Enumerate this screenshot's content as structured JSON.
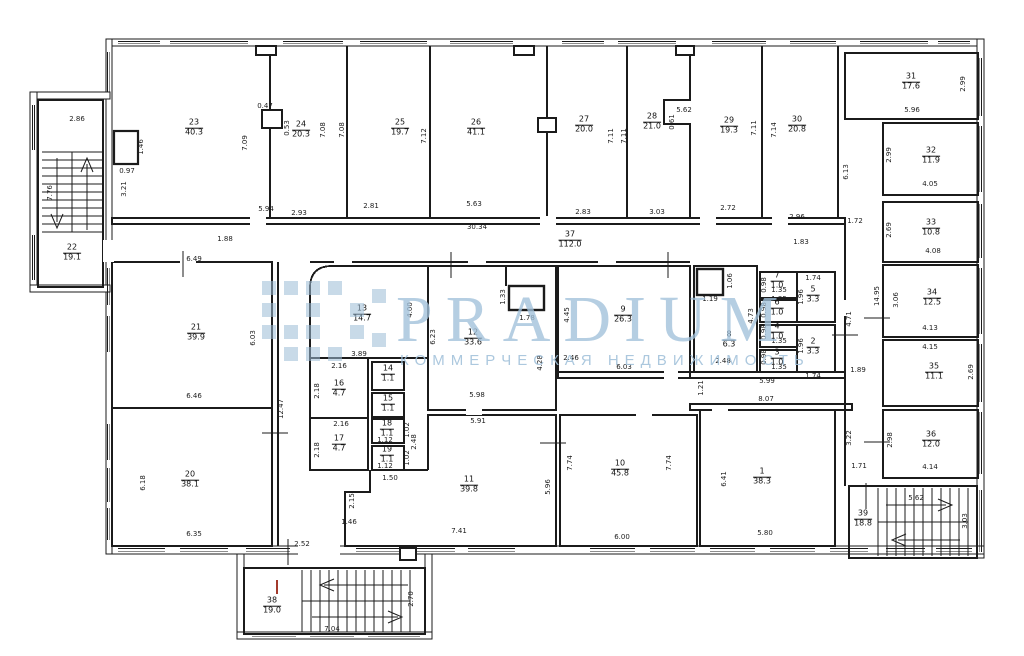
{
  "watermark": {
    "brand": "PRADIUM",
    "subtitle": "КОММЕРЧЕСКАЯ НЕДВИЖИМОСТЬ",
    "color": "#a0c0da"
  },
  "plan": {
    "rooms": [
      {
        "n": "1",
        "a": "38.3",
        "x": 762,
        "y": 477
      },
      {
        "n": "2",
        "a": "3.3",
        "x": 813,
        "y": 347
      },
      {
        "n": "3",
        "a": "1.0",
        "x": 777,
        "y": 358
      },
      {
        "n": "4",
        "a": "1.0",
        "x": 777,
        "y": 332
      },
      {
        "n": "5",
        "a": "3.3",
        "x": 813,
        "y": 295
      },
      {
        "n": "6",
        "a": "1.0",
        "x": 777,
        "y": 308
      },
      {
        "n": "7",
        "a": "1.0",
        "x": 777,
        "y": 281
      },
      {
        "n": "8",
        "a": "6.3",
        "x": 729,
        "y": 340
      },
      {
        "n": "9",
        "a": "26.3",
        "x": 623,
        "y": 315
      },
      {
        "n": "10",
        "a": "45.8",
        "x": 620,
        "y": 469
      },
      {
        "n": "11",
        "a": "39.8",
        "x": 469,
        "y": 485
      },
      {
        "n": "12",
        "a": "33.6",
        "x": 473,
        "y": 338
      },
      {
        "n": "13",
        "a": "14.7",
        "x": 362,
        "y": 314
      },
      {
        "n": "14",
        "a": "1.1",
        "x": 388,
        "y": 374
      },
      {
        "n": "15",
        "a": "1.1",
        "x": 388,
        "y": 404
      },
      {
        "n": "16",
        "a": "4.7",
        "x": 339,
        "y": 389
      },
      {
        "n": "17",
        "a": "4.7",
        "x": 339,
        "y": 444
      },
      {
        "n": "18",
        "a": "1.1",
        "x": 387,
        "y": 429
      },
      {
        "n": "19",
        "a": "1.1",
        "x": 387,
        "y": 455
      },
      {
        "n": "20",
        "a": "38.1",
        "x": 190,
        "y": 480
      },
      {
        "n": "21",
        "a": "39.9",
        "x": 196,
        "y": 333
      },
      {
        "n": "22",
        "a": "19.1",
        "x": 72,
        "y": 253
      },
      {
        "n": "23",
        "a": "40.3",
        "x": 194,
        "y": 128
      },
      {
        "n": "24",
        "a": "20.3",
        "x": 301,
        "y": 130
      },
      {
        "n": "25",
        "a": "19.7",
        "x": 400,
        "y": 128
      },
      {
        "n": "26",
        "a": "41.1",
        "x": 476,
        "y": 128
      },
      {
        "n": "27",
        "a": "20.0",
        "x": 584,
        "y": 125
      },
      {
        "n": "28",
        "a": "21.0",
        "x": 652,
        "y": 122
      },
      {
        "n": "29",
        "a": "19.3",
        "x": 729,
        "y": 126
      },
      {
        "n": "30",
        "a": "20.8",
        "x": 797,
        "y": 125
      },
      {
        "n": "31",
        "a": "17.6",
        "x": 911,
        "y": 82
      },
      {
        "n": "32",
        "a": "11.9",
        "x": 931,
        "y": 156
      },
      {
        "n": "33",
        "a": "10.8",
        "x": 931,
        "y": 228
      },
      {
        "n": "34",
        "a": "12.5",
        "x": 932,
        "y": 298
      },
      {
        "n": "35",
        "a": "11.1",
        "x": 934,
        "y": 372
      },
      {
        "n": "36",
        "a": "12.0",
        "x": 931,
        "y": 440
      },
      {
        "n": "37",
        "a": "112.0",
        "x": 570,
        "y": 240
      },
      {
        "n": "38",
        "a": "19.0",
        "x": 272,
        "y": 606
      },
      {
        "n": "39",
        "a": "18.8",
        "x": 863,
        "y": 519
      }
    ],
    "dims": [
      {
        "v": "2.86",
        "x": 77,
        "y": 119,
        "o": "h"
      },
      {
        "v": "7.76",
        "x": 50,
        "y": 193,
        "o": "v"
      },
      {
        "v": "1.46",
        "x": 141,
        "y": 147,
        "o": "v"
      },
      {
        "v": "0.97",
        "x": 127,
        "y": 171,
        "o": "h"
      },
      {
        "v": "3.21",
        "x": 124,
        "y": 189,
        "o": "v"
      },
      {
        "v": "5.94",
        "x": 266,
        "y": 209,
        "o": "h"
      },
      {
        "v": "7.09",
        "x": 245,
        "y": 143,
        "o": "v"
      },
      {
        "v": "0.47",
        "x": 265,
        "y": 106,
        "o": "h"
      },
      {
        "v": "0.53",
        "x": 287,
        "y": 128,
        "o": "v"
      },
      {
        "v": "2.93",
        "x": 299,
        "y": 213,
        "o": "h"
      },
      {
        "v": "7.08",
        "x": 323,
        "y": 130,
        "o": "v"
      },
      {
        "v": "7.08",
        "x": 342,
        "y": 130,
        "o": "v"
      },
      {
        "v": "2.81",
        "x": 371,
        "y": 206,
        "o": "h"
      },
      {
        "v": "7.12",
        "x": 424,
        "y": 136,
        "o": "v"
      },
      {
        "v": "5.63",
        "x": 474,
        "y": 204,
        "o": "h"
      },
      {
        "v": "30.34",
        "x": 477,
        "y": 227,
        "o": "h"
      },
      {
        "v": "2.83",
        "x": 583,
        "y": 212,
        "o": "h"
      },
      {
        "v": "7.11",
        "x": 611,
        "y": 136,
        "o": "v"
      },
      {
        "v": "7.11",
        "x": 624,
        "y": 136,
        "o": "v"
      },
      {
        "v": "3.03",
        "x": 657,
        "y": 212,
        "o": "h"
      },
      {
        "v": "5.62",
        "x": 684,
        "y": 110,
        "o": "h"
      },
      {
        "v": "0.61",
        "x": 672,
        "y": 122,
        "o": "v"
      },
      {
        "v": "2.72",
        "x": 728,
        "y": 208,
        "o": "h"
      },
      {
        "v": "7.11",
        "x": 754,
        "y": 128,
        "o": "v"
      },
      {
        "v": "7.14",
        "x": 774,
        "y": 130,
        "o": "v"
      },
      {
        "v": "2.96",
        "x": 797,
        "y": 217,
        "o": "h"
      },
      {
        "v": "1.88",
        "x": 225,
        "y": 239,
        "o": "h"
      },
      {
        "v": "1.83",
        "x": 801,
        "y": 242,
        "o": "h"
      },
      {
        "v": "1.72",
        "x": 855,
        "y": 221,
        "o": "h"
      },
      {
        "v": "6.13",
        "x": 846,
        "y": 172,
        "o": "v"
      },
      {
        "v": "5.96",
        "x": 912,
        "y": 110,
        "o": "h"
      },
      {
        "v": "2.99",
        "x": 963,
        "y": 84,
        "o": "v"
      },
      {
        "v": "4.05",
        "x": 930,
        "y": 184,
        "o": "h"
      },
      {
        "v": "2.99",
        "x": 889,
        "y": 155,
        "o": "v"
      },
      {
        "v": "4.08",
        "x": 933,
        "y": 251,
        "o": "h"
      },
      {
        "v": "2.69",
        "x": 889,
        "y": 230,
        "o": "v"
      },
      {
        "v": "14.95",
        "x": 877,
        "y": 296,
        "o": "v"
      },
      {
        "v": "3.06",
        "x": 896,
        "y": 300,
        "o": "v"
      },
      {
        "v": "4.13",
        "x": 930,
        "y": 328,
        "o": "h"
      },
      {
        "v": "4.15",
        "x": 930,
        "y": 347,
        "o": "h"
      },
      {
        "v": "2.69",
        "x": 971,
        "y": 372,
        "o": "v"
      },
      {
        "v": "4.71",
        "x": 849,
        "y": 319,
        "o": "v"
      },
      {
        "v": "1.89",
        "x": 858,
        "y": 370,
        "o": "h"
      },
      {
        "v": "3.22",
        "x": 849,
        "y": 438,
        "o": "v"
      },
      {
        "v": "1.71",
        "x": 859,
        "y": 466,
        "o": "h"
      },
      {
        "v": "2.98",
        "x": 890,
        "y": 440,
        "o": "v"
      },
      {
        "v": "4.14",
        "x": 930,
        "y": 467,
        "o": "h"
      },
      {
        "v": "5.62",
        "x": 916,
        "y": 498,
        "o": "h"
      },
      {
        "v": "3.03",
        "x": 965,
        "y": 521,
        "o": "v"
      },
      {
        "v": "6.49",
        "x": 194,
        "y": 259,
        "o": "h"
      },
      {
        "v": "6.03",
        "x": 253,
        "y": 338,
        "o": "v"
      },
      {
        "v": "6.46",
        "x": 194,
        "y": 396,
        "o": "h"
      },
      {
        "v": "12.47",
        "x": 281,
        "y": 409,
        "o": "v"
      },
      {
        "v": "6.18",
        "x": 143,
        "y": 483,
        "o": "v"
      },
      {
        "v": "6.35",
        "x": 194,
        "y": 534,
        "o": "h"
      },
      {
        "v": "2.52",
        "x": 302,
        "y": 544,
        "o": "h"
      },
      {
        "v": "3.89",
        "x": 359,
        "y": 354,
        "o": "h"
      },
      {
        "v": "4.00",
        "x": 410,
        "y": 310,
        "o": "v"
      },
      {
        "v": "2.16",
        "x": 339,
        "y": 366,
        "o": "h"
      },
      {
        "v": "2.18",
        "x": 317,
        "y": 391,
        "o": "v"
      },
      {
        "v": "2.16",
        "x": 341,
        "y": 424,
        "o": "h"
      },
      {
        "v": "2.18",
        "x": 317,
        "y": 450,
        "o": "v"
      },
      {
        "v": "1.12",
        "x": 385,
        "y": 440,
        "o": "h"
      },
      {
        "v": "1.02",
        "x": 407,
        "y": 430,
        "o": "v"
      },
      {
        "v": "1.12",
        "x": 385,
        "y": 466,
        "o": "h"
      },
      {
        "v": "1.02",
        "x": 407,
        "y": 458,
        "o": "v"
      },
      {
        "v": "1.50",
        "x": 390,
        "y": 478,
        "o": "h"
      },
      {
        "v": "2.48",
        "x": 414,
        "y": 442,
        "o": "v"
      },
      {
        "v": "6.23",
        "x": 433,
        "y": 337,
        "o": "v"
      },
      {
        "v": "1.33",
        "x": 503,
        "y": 297,
        "o": "v"
      },
      {
        "v": "1.78",
        "x": 527,
        "y": 318,
        "o": "h"
      },
      {
        "v": "4.28",
        "x": 540,
        "y": 363,
        "o": "v"
      },
      {
        "v": "5.98",
        "x": 477,
        "y": 395,
        "o": "h"
      },
      {
        "v": "5.91",
        "x": 478,
        "y": 421,
        "o": "h"
      },
      {
        "v": "4.45",
        "x": 567,
        "y": 315,
        "o": "v"
      },
      {
        "v": "2.46",
        "x": 571,
        "y": 358,
        "o": "h"
      },
      {
        "v": "6.03",
        "x": 624,
        "y": 367,
        "o": "h"
      },
      {
        "v": "7.74",
        "x": 570,
        "y": 463,
        "o": "v"
      },
      {
        "v": "7.74",
        "x": 669,
        "y": 463,
        "o": "v"
      },
      {
        "v": "6.00",
        "x": 622,
        "y": 537,
        "o": "h"
      },
      {
        "v": "2.15",
        "x": 352,
        "y": 501,
        "o": "v"
      },
      {
        "v": "1.46",
        "x": 349,
        "y": 522,
        "o": "h"
      },
      {
        "v": "7.41",
        "x": 459,
        "y": 531,
        "o": "h"
      },
      {
        "v": "5.96",
        "x": 548,
        "y": 487,
        "o": "v"
      },
      {
        "v": "1.19",
        "x": 710,
        "y": 299,
        "o": "h"
      },
      {
        "v": "1.06",
        "x": 730,
        "y": 281,
        "o": "v"
      },
      {
        "v": "4.73",
        "x": 751,
        "y": 316,
        "o": "v"
      },
      {
        "v": "2.48",
        "x": 723,
        "y": 361,
        "o": "h"
      },
      {
        "v": "1.21",
        "x": 701,
        "y": 388,
        "o": "v"
      },
      {
        "v": "0.98",
        "x": 764,
        "y": 285,
        "o": "v"
      },
      {
        "v": "1.35",
        "x": 779,
        "y": 290,
        "o": "h"
      },
      {
        "v": "1.35",
        "x": 779,
        "y": 299,
        "o": "h"
      },
      {
        "v": "0.98",
        "x": 764,
        "y": 310,
        "o": "v"
      },
      {
        "v": "1.74",
        "x": 813,
        "y": 278,
        "o": "h"
      },
      {
        "v": "1.96",
        "x": 801,
        "y": 297,
        "o": "v"
      },
      {
        "v": "1.35",
        "x": 779,
        "y": 341,
        "o": "h"
      },
      {
        "v": "0.98",
        "x": 764,
        "y": 332,
        "o": "v"
      },
      {
        "v": "1.35",
        "x": 779,
        "y": 367,
        "o": "h"
      },
      {
        "v": "0.98",
        "x": 764,
        "y": 357,
        "o": "v"
      },
      {
        "v": "1.96",
        "x": 801,
        "y": 346,
        "o": "v"
      },
      {
        "v": "1.74",
        "x": 813,
        "y": 376,
        "o": "h"
      },
      {
        "v": "5.99",
        "x": 767,
        "y": 381,
        "o": "h"
      },
      {
        "v": "8.07",
        "x": 766,
        "y": 399,
        "o": "h"
      },
      {
        "v": "6.41",
        "x": 724,
        "y": 479,
        "o": "v"
      },
      {
        "v": "5.80",
        "x": 765,
        "y": 533,
        "o": "h"
      },
      {
        "v": "2.70",
        "x": 411,
        "y": 599,
        "o": "v"
      },
      {
        "v": "7.04",
        "x": 332,
        "y": 629,
        "o": "h"
      }
    ]
  }
}
